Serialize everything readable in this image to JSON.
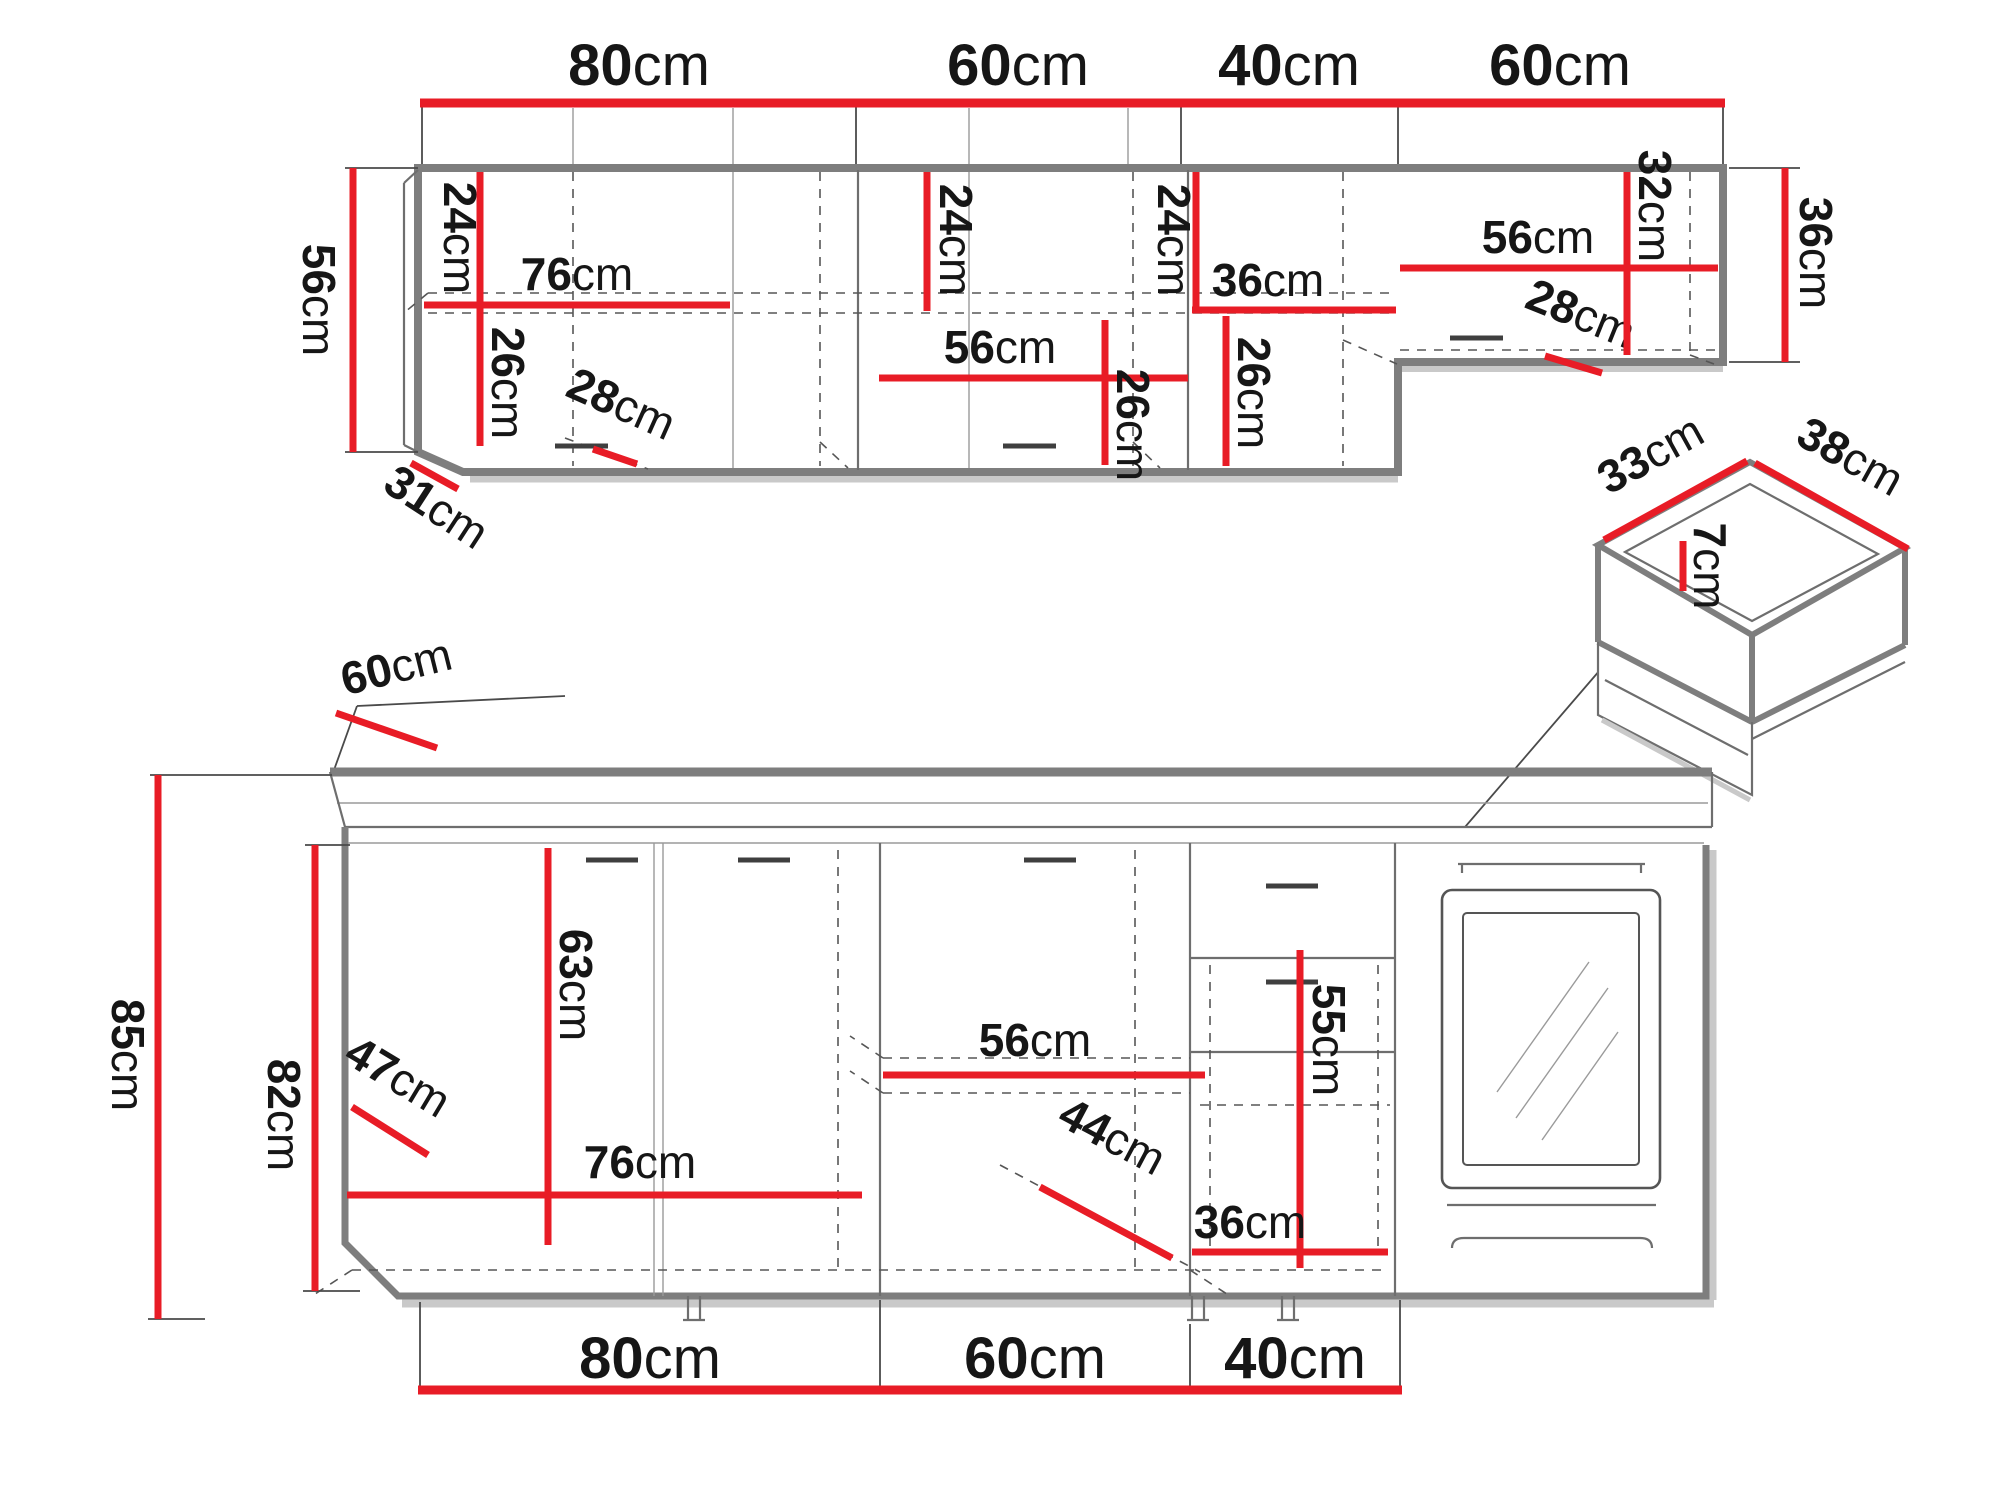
{
  "title": "kitchen cabinet set dimension diagram",
  "colors": {
    "dimension_red": "#e81c26",
    "outline_gray": "#7e7e7e",
    "structure_dark": "#4a4a4a",
    "text_black": "#161616",
    "background": "#ffffff"
  },
  "upper": {
    "top_widths": [
      {
        "value": "80",
        "unit": "cm"
      },
      {
        "value": "60",
        "unit": "cm"
      },
      {
        "value": "40",
        "unit": "cm"
      },
      {
        "value": "60",
        "unit": "cm"
      }
    ],
    "marks": {
      "left_height": {
        "value": "56",
        "unit": "cm"
      },
      "left_depth": {
        "value": "31",
        "unit": "cm"
      },
      "a_shelf_top": {
        "value": "24",
        "unit": "cm"
      },
      "a_inner_width": {
        "value": "76",
        "unit": "cm"
      },
      "a_shelf_bottom": {
        "value": "26",
        "unit": "cm"
      },
      "a_depth": {
        "value": "28",
        "unit": "cm"
      },
      "b_shelf_top": {
        "value": "24",
        "unit": "cm"
      },
      "b_inner_width": {
        "value": "56",
        "unit": "cm"
      },
      "b_shelf_bottom": {
        "value": "26",
        "unit": "cm"
      },
      "c_shelf_top": {
        "value": "24",
        "unit": "cm"
      },
      "c_inner_width": {
        "value": "36",
        "unit": "cm"
      },
      "c_shelf_bottom": {
        "value": "26",
        "unit": "cm"
      },
      "d_inner_width": {
        "value": "56",
        "unit": "cm"
      },
      "d_depth": {
        "value": "28",
        "unit": "cm"
      },
      "d_inner_height": {
        "value": "32",
        "unit": "cm"
      },
      "right_height": {
        "value": "36",
        "unit": "cm"
      }
    }
  },
  "drawer": {
    "marks": {
      "side_width": {
        "value": "33",
        "unit": "cm"
      },
      "side_depth": {
        "value": "38",
        "unit": "cm"
      },
      "inner_height": {
        "value": "7",
        "unit": "cm"
      }
    }
  },
  "lower": {
    "marks": {
      "counter_depth": {
        "value": "60",
        "unit": "cm"
      },
      "total_height": {
        "value": "85",
        "unit": "cm"
      },
      "carcass_height": {
        "value": "82",
        "unit": "cm"
      },
      "inner_depth": {
        "value": "47",
        "unit": "cm"
      },
      "door_height": {
        "value": "63",
        "unit": "cm"
      },
      "a_inner_width": {
        "value": "76",
        "unit": "cm"
      },
      "b_inner_width": {
        "value": "56",
        "unit": "cm"
      },
      "b_inner_depth": {
        "value": "44",
        "unit": "cm"
      },
      "c_inner_height": {
        "value": "55",
        "unit": "cm"
      },
      "c_inner_width": {
        "value": "36",
        "unit": "cm"
      }
    },
    "bottom_widths": [
      {
        "value": "80",
        "unit": "cm"
      },
      {
        "value": "60",
        "unit": "cm"
      },
      {
        "value": "40",
        "unit": "cm"
      }
    ]
  }
}
